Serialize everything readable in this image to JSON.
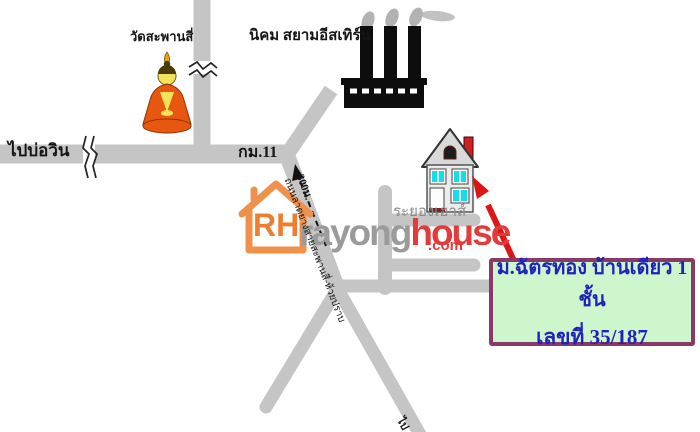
{
  "map": {
    "labels": {
      "temple": "วัดสะพานสี่",
      "industrial_estate": "นิคม สยามอีสเทิร์น",
      "to_bowin": "ไปบ่อวิน",
      "km11": "กม.11",
      "distance": "300ม.",
      "road_name": "ถนนลาดยางสายสะพานสี่-ห้วยปราบ",
      "house_label": "ระยองเฮาส์",
      "bottom_road": "ไป"
    },
    "logo": {
      "initials": "RH",
      "word1": "rayong",
      "word2": "house",
      "tld": ".com",
      "house_color": "#f0914b",
      "initials_color": "#ed7d31",
      "word1_color": "#9b9b9b",
      "word2_color": "#e23b3b"
    },
    "info_box": {
      "line1": "ม.ฉัตรทอง บ้านเดียว 1 ชั้น",
      "line2": "เลขที่ 35/187",
      "bg": "#cdf6cd",
      "border_color": "#8a3a66",
      "text_color": "#2222bb"
    },
    "colors": {
      "road": "#c5c5c5",
      "road_break": "#222222",
      "label_text": "#151515",
      "house_label_gray": "#8a8a8a",
      "arrow_red": "#dd1515",
      "factory_black": "#0d0d0d",
      "smoke_gray": "#b2b2b2",
      "window_cyan": "#19dce8",
      "chimney_red": "#cf1f1f",
      "buddha_robe": "#e8570f",
      "buddha_skin": "#f2e25c",
      "dashed_arrow": "#111111"
    }
  }
}
